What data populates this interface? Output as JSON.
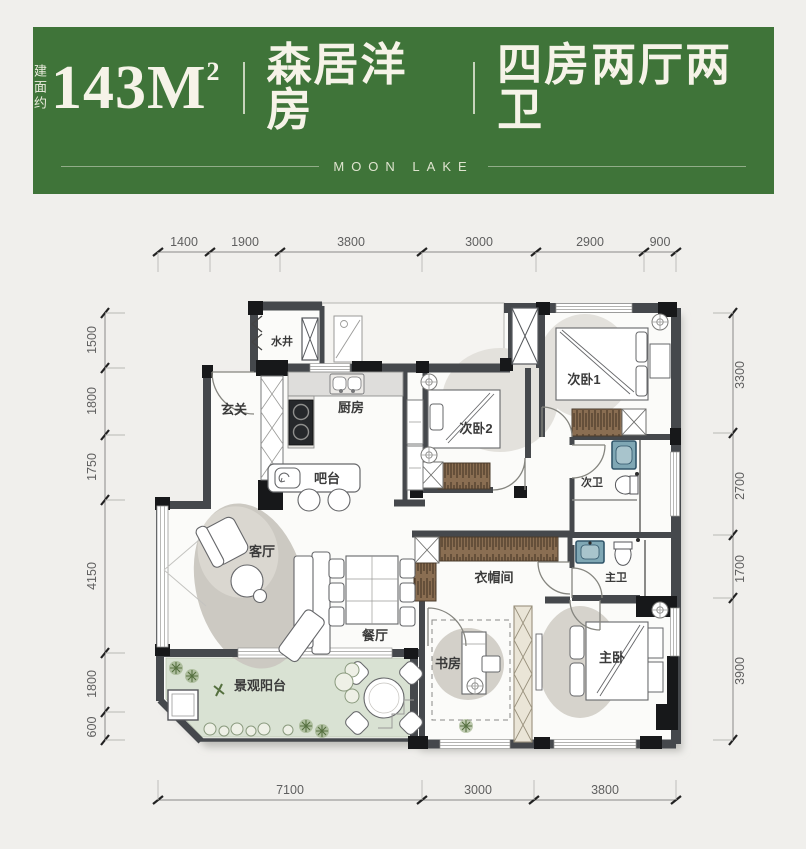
{
  "header": {
    "area_prefix": "建面约",
    "area_value": "143M",
    "area_sup": "2",
    "product_name": "森居洋房",
    "layout_name": "四房两厅两卫",
    "brand": "MOON LAKE",
    "bg_color": "#3f7439",
    "text_color": "#f6f3e8"
  },
  "plan": {
    "rooms": [
      {
        "id": "shaft",
        "label": "水井"
      },
      {
        "id": "foyer",
        "label": "玄关"
      },
      {
        "id": "kitchen",
        "label": "厨房"
      },
      {
        "id": "bedroom2",
        "label": "次卧2"
      },
      {
        "id": "bedroom1",
        "label": "次卧1"
      },
      {
        "id": "bar",
        "label": "吧台"
      },
      {
        "id": "bath2",
        "label": "次卫"
      },
      {
        "id": "living",
        "label": "客厅"
      },
      {
        "id": "cloakroom",
        "label": "衣帽间"
      },
      {
        "id": "masterbath",
        "label": "主卫"
      },
      {
        "id": "dining",
        "label": "餐厅"
      },
      {
        "id": "study",
        "label": "书房"
      },
      {
        "id": "masterbed",
        "label": "主卧"
      },
      {
        "id": "balcony",
        "label": "景观阳台"
      }
    ],
    "dims": {
      "top": [
        "1400",
        "1900",
        "3800",
        "3000",
        "2900",
        "900"
      ],
      "left": [
        "1500",
        "1800",
        "1750",
        "4150",
        "1800",
        "600"
      ],
      "right": [
        "3300",
        "2700",
        "1700",
        "3900"
      ],
      "bottom": [
        "7100",
        "3000",
        "3800"
      ]
    },
    "colors": {
      "wall": "#45484c",
      "column_black": "#17181a",
      "floor": "#fbfbf9",
      "balcony_floor": "#d9e2d3",
      "wardrobe": "#8a6e52",
      "basin": "#7fa7b4",
      "rug": "#ccc9c2"
    }
  }
}
